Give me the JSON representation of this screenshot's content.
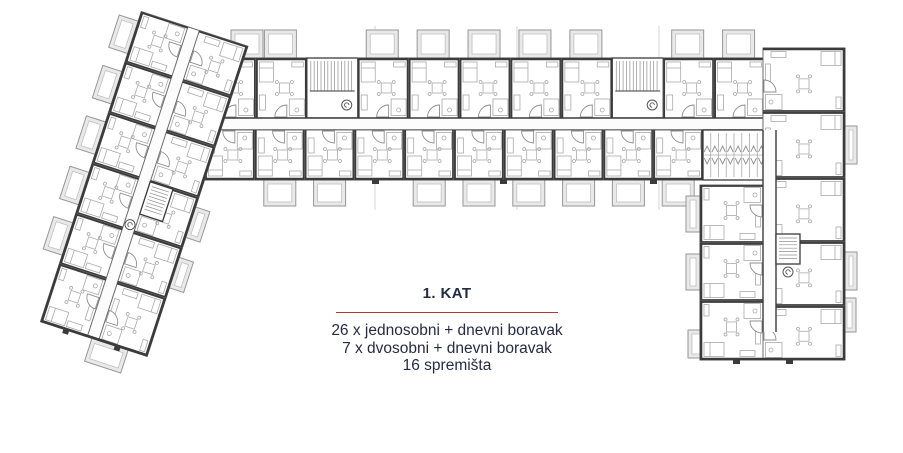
{
  "legend": {
    "title": "1. KAT",
    "lines": [
      "26 x jednosobni + dnevni boravak",
      "7 x dvosobni + dnevni boravak",
      "16 spremišta"
    ],
    "accent_color": "#ad3a35",
    "text_color": "#262b44"
  },
  "plan": {
    "ink": {
      "wall": "#3b3b3b",
      "outline": "#6b6b6b",
      "furniture": "#aaaaaa",
      "detail": "#8f8f8f",
      "balcony_fill": "#e9e9e9",
      "balcony_stroke": "#969696",
      "corridor": "#fcfcfc",
      "joint": "#d6d6d6"
    },
    "expansion_joints_x": [
      375,
      517,
      659
    ],
    "horizontal_wing": {
      "x": 205,
      "y": 58,
      "w": 560,
      "top_h": 60,
      "corridor_y": 118,
      "corridor_h": 12,
      "bottom_y": 130,
      "bottom_h": 50,
      "bottom_end": 703,
      "units_top": 11,
      "units_bottom": 10,
      "stair_units": [
        2,
        8
      ],
      "no_balcony_bottom": [
        0,
        3
      ],
      "balcony_top": {
        "y": 30,
        "w": 32,
        "h": 28
      },
      "balcony_bottom": {
        "y": 180,
        "w": 32,
        "h": 26
      }
    },
    "storage": {
      "x": 703,
      "y": 130,
      "w": 62,
      "h": 50,
      "cells": 8
    },
    "vertical_wing": {
      "right_col": {
        "x": 763,
        "w": 82,
        "rows": [
          [
            48,
            64
          ],
          [
            112,
            66
          ],
          [
            178,
            64
          ],
          [
            242,
            64
          ],
          [
            306,
            54
          ]
        ]
      },
      "left_col": {
        "x": 700,
        "w": 63,
        "rows": [
          [
            185,
            58
          ],
          [
            243,
            58
          ],
          [
            301,
            59
          ]
        ]
      },
      "corridor": {
        "x": 763,
        "y": 130,
        "w": 13,
        "h": 202
      },
      "stair": {
        "x": 776,
        "y": 234,
        "w": 24,
        "h": 30
      },
      "lift": [
        788,
        272
      ],
      "balconies": [
        [
          845,
          126,
          12,
          38
        ],
        [
          845,
          252,
          12,
          38
        ],
        [
          843,
          298,
          13,
          34
        ],
        [
          800,
          334,
          42,
          26
        ],
        [
          686,
          196,
          14,
          36
        ],
        [
          686,
          254,
          14,
          36
        ],
        [
          688,
          330,
          40,
          28
        ]
      ],
      "stubs": [
        [
          733,
          360,
          7,
          4
        ],
        [
          786,
          360,
          7,
          4
        ]
      ]
    },
    "diagonal_wing": {
      "pivot": [
        246,
        52
      ],
      "angle": 18,
      "width": 112,
      "length": 326,
      "row_y": [
        -6,
        47,
        100,
        153,
        206,
        259
      ],
      "row_h": [
        53,
        53,
        53,
        53,
        53,
        61
      ],
      "corridor_x": -63,
      "corridor_w": 12,
      "left_balcony_rows": [
        0,
        1,
        2,
        3,
        4
      ],
      "right_balcony_rows": [
        3,
        4
      ],
      "bottom_balcony": [
        -58,
        320,
        38,
        24
      ],
      "stair": [
        -51,
        153,
        24,
        34
      ],
      "lift": [
        -57,
        200
      ],
      "stubs": [
        [
          -88,
          320,
          6,
          4
        ],
        [
          -34,
          320,
          6,
          4
        ]
      ]
    },
    "hw_stubs_x": [
      372,
      500,
      650
    ]
  }
}
